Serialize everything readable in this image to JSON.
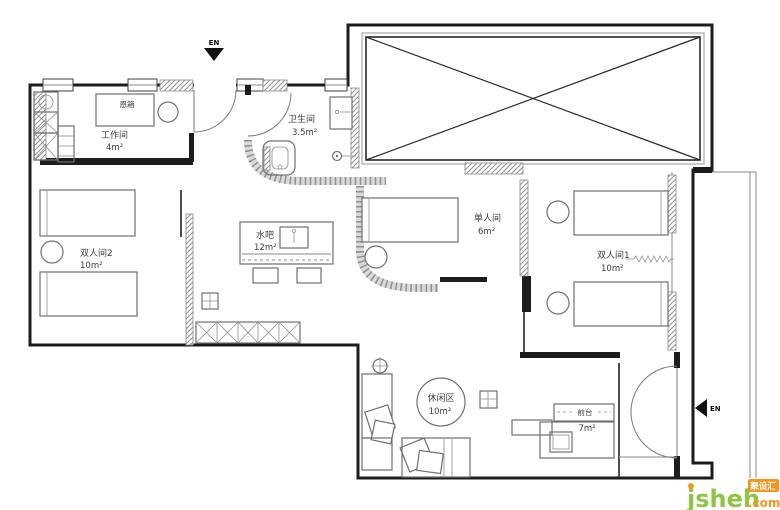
{
  "canvas": {
    "width": 780,
    "height": 510,
    "background": "#ffffff"
  },
  "palette": {
    "wall": "#1c1c1c",
    "furniture_line": "#707070",
    "hatch_line": "#8a8a8a",
    "label_color": "#3c3c3c",
    "logo_green": "#8dc63f",
    "logo_orange": "#f7941d"
  },
  "compass": {
    "top_entry_label": "EN",
    "side_entry_label": "EN"
  },
  "rooms": {
    "workroom": {
      "name": "工作间",
      "area": "4m²"
    },
    "bathroom": {
      "name": "卫生间",
      "area": "3.5m²"
    },
    "double_room_2": {
      "name": "双人间2",
      "area": "10m²"
    },
    "water_bar": {
      "name": "水吧",
      "area": "12m²"
    },
    "single_room": {
      "name": "单人间",
      "area": "6m²"
    },
    "double_room_1": {
      "name": "双人间1",
      "area": "10m²"
    },
    "leisure_area": {
      "name": "休闲区",
      "area": "10m²"
    },
    "front_desk": {
      "name": "前台",
      "area": "7m²"
    }
  },
  "furniture": {
    "box_label": "恩箱"
  },
  "watermark": {
    "brand": "jsheh",
    "tld": ".com",
    "badge": "聚设汇"
  }
}
